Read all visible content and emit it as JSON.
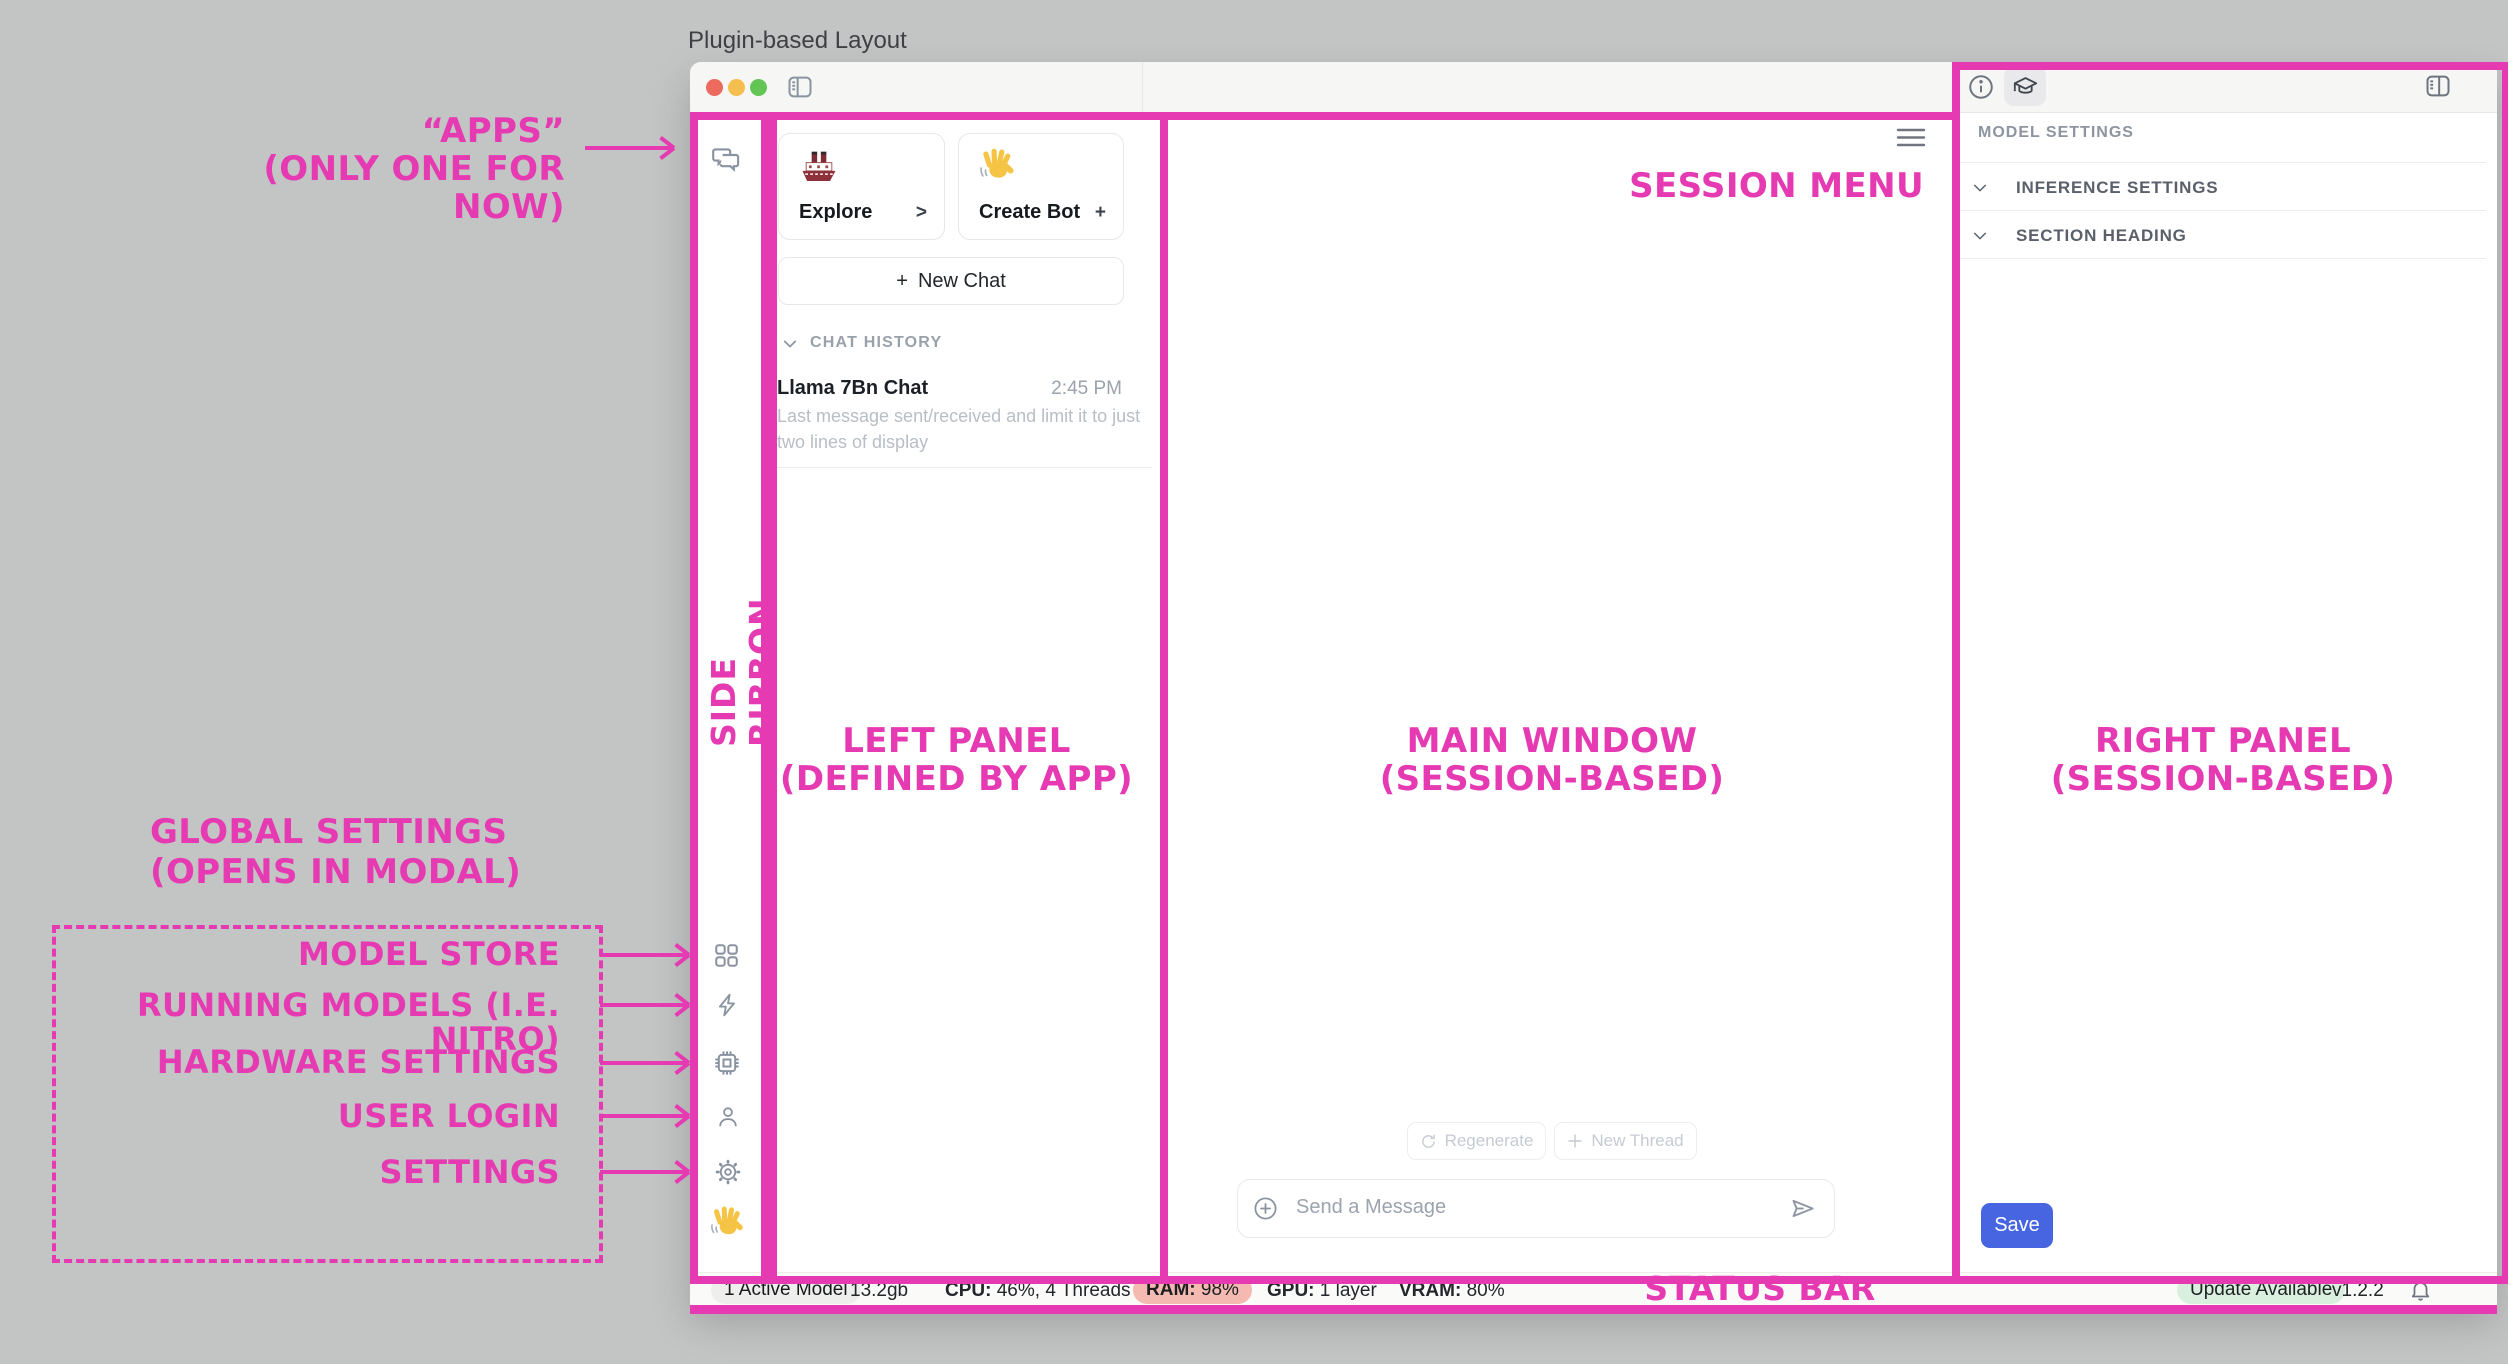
{
  "page": {
    "title": "Plugin-based Layout"
  },
  "colors": {
    "annotation_pink": "#E53AB2",
    "save_blue": "#4765E1",
    "ram_pill_bg": "#F4B9B1",
    "update_pill_bg": "#D9F0DF",
    "traffic_red": "#EC6A5E",
    "traffic_yellow": "#F5BF4F",
    "traffic_green": "#62C554"
  },
  "ribbon": {
    "icons": [
      "chat-bubbles-icon",
      "grid-icon",
      "lightning-icon",
      "chip-icon",
      "user-icon",
      "gear-icon",
      "wave-hand-icon"
    ]
  },
  "left_panel": {
    "cards": [
      {
        "icon": "ship-emoji",
        "label": "Explore",
        "action": ">"
      },
      {
        "icon": "wave-hand-emoji",
        "label": "Create Bot",
        "action": "+"
      }
    ],
    "new_chat_plus": "+",
    "new_chat": "New Chat",
    "history_header": "CHAT HISTORY",
    "chat": {
      "title": "Llama 7Bn Chat",
      "time": "2:45 PM",
      "preview": "Last message sent/received and limit it to just two lines of display"
    }
  },
  "main": {
    "regenerate": "Regenerate",
    "new_thread": "New Thread",
    "composer_placeholder": "Send a Message"
  },
  "right_panel": {
    "header": "MODEL SETTINGS",
    "sections": [
      {
        "label": "INFERENCE SETTINGS"
      },
      {
        "label": "SECTION HEADING"
      }
    ],
    "save": "Save"
  },
  "status_bar": {
    "active_model": "1 Active Model",
    "memory": "13.2gb",
    "cpu_label": "CPU:",
    "cpu_value": "46%, 4 Threads",
    "ram_label": "RAM:",
    "ram_value": "98%",
    "gpu_label": "GPU:",
    "gpu_value": "1 layer",
    "vram_label": "VRAM:",
    "vram_value": "80%",
    "update": "Update Available",
    "version": "v1.2.2"
  },
  "annotations": {
    "apps_line1": "“APPS”",
    "apps_line2": "(ONLY ONE FOR NOW)",
    "side_ribbon": "SIDE RIBBON",
    "left_panel_line1": "LEFT PANEL",
    "left_panel_line2": "(DEFINED BY APP)",
    "main_window_line1": "MAIN WINDOW",
    "main_window_line2": "(SESSION-BASED)",
    "right_panel_line1": "RIGHT PANEL",
    "right_panel_line2": "(SESSION-BASED)",
    "session_menu": "SESSION MENU",
    "status_bar": "STATUS BAR",
    "global_line1": "GLOBAL SETTINGS",
    "global_line2": "(OPENS IN MODAL)",
    "modal_items": [
      {
        "label": "MODEL STORE"
      },
      {
        "label": "RUNNING MODELS (I.E. NITRO)"
      },
      {
        "label": "HARDWARE SETTINGS"
      },
      {
        "label": "USER LOGIN"
      },
      {
        "label": "SETTINGS"
      }
    ]
  }
}
